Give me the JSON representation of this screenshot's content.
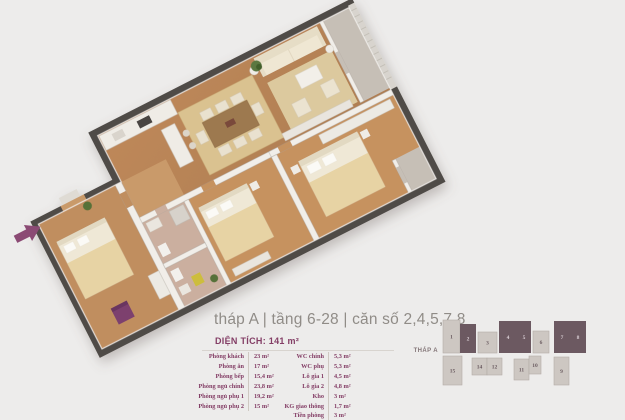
{
  "colors": {
    "background": "#edeceb",
    "title": "#908c87",
    "maroon": "#833d65",
    "arrow": "#8b4a74",
    "unit_light": "#cdc7c2",
    "unit_light_stroke": "#b3aca6",
    "unit_dark": "#6c5961",
    "unit_num_light": "#695a5f",
    "unit_num_dark": "#d9ced4"
  },
  "header": {
    "title": "tháp A | tầng 6-28 | căn số 2,4,5,7,8",
    "area": "DIỆN TÍCH: 141 m²"
  },
  "room_table": {
    "left": [
      {
        "label": "Phòng khách",
        "value": "23 m²"
      },
      {
        "label": "Phòng ăn",
        "value": "17 m²"
      },
      {
        "label": "Phòng bếp",
        "value": "15,4 m²"
      },
      {
        "label": "Phòng ngủ chính",
        "value": "23,8 m²"
      },
      {
        "label": "Phòng ngủ phụ 1",
        "value": "19,2 m²"
      },
      {
        "label": "Phòng ngủ phụ 2",
        "value": "15 m²"
      }
    ],
    "right": [
      {
        "label": "WC chính",
        "value": "5,3 m²"
      },
      {
        "label": "WC phụ",
        "value": "5,3 m²"
      },
      {
        "label": "Lô gia 1",
        "value": "4,5 m²"
      },
      {
        "label": "Lô gia 2",
        "value": "4,8 m²"
      },
      {
        "label": "Kho",
        "value": "3 m²"
      },
      {
        "label": "KG giao thông",
        "value": "1,7 m²"
      },
      {
        "label": "Tiền phòng",
        "value": "3 m²"
      }
    ]
  },
  "key_plan": {
    "tower_label": "THÁP A",
    "highlighted_units": "2,4,5,7,8",
    "units": [
      {
        "num": "1",
        "dark": false
      },
      {
        "num": "2",
        "dark": true
      },
      {
        "num": "3",
        "dark": false
      },
      {
        "num": "4",
        "dark": true
      },
      {
        "num": "5",
        "dark": true
      },
      {
        "num": "6",
        "dark": false
      },
      {
        "num": "7",
        "dark": true
      },
      {
        "num": "8",
        "dark": true
      },
      {
        "num": "15",
        "dark": false
      },
      {
        "num": "14",
        "dark": false
      },
      {
        "num": "12",
        "dark": false
      },
      {
        "num": "11",
        "dark": false
      },
      {
        "num": "10",
        "dark": false
      },
      {
        "num": "9",
        "dark": false
      }
    ]
  }
}
